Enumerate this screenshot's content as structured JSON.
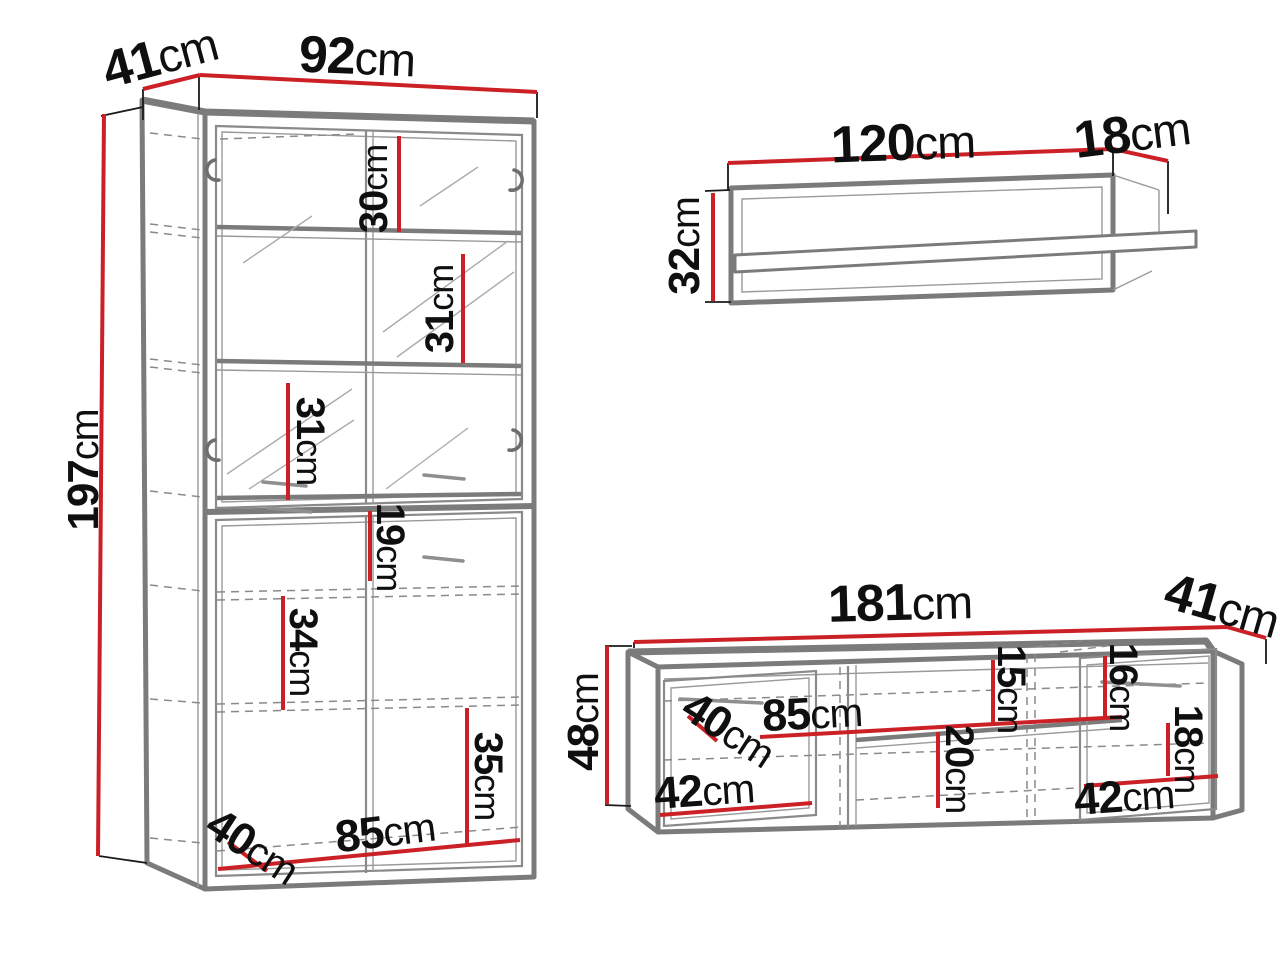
{
  "unit": "cm",
  "colors": {
    "dimension_line": "#cc2027",
    "drawing_line": "#7b7b7b"
  },
  "furniture": {
    "display_cabinet": {
      "width": "92",
      "depth": "41",
      "height": "197",
      "glass_shelf_top": "30",
      "glass_shelf_middle": "31",
      "glass_shelf_bottom": "31",
      "lower_top_gap": "19",
      "lower_shelf_middle": "34",
      "lower_shelf_bottom": "35",
      "interior_depth": "40",
      "interior_width": "85"
    },
    "wall_shelf": {
      "width": "120",
      "depth": "18",
      "height": "32"
    },
    "tv_stand": {
      "width": "181",
      "depth": "41",
      "height": "48",
      "interior_depth": "40",
      "left_door_width": "42",
      "middle_width": "85",
      "middle_top_gap": "15",
      "middle_bottom_gap": "20",
      "right_top_gap": "16",
      "right_middle_gap": "18",
      "right_door_width": "42"
    }
  }
}
